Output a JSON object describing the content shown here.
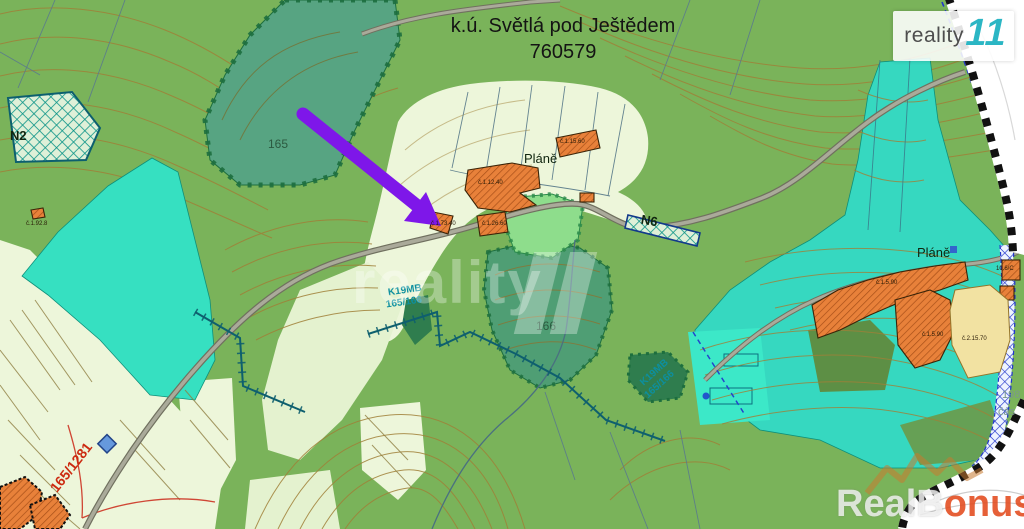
{
  "map": {
    "title": {
      "line1": "k.ú. Světlá pod Ještědem",
      "line2": "760579"
    },
    "labels": {
      "forest_parcel": "165",
      "n2": "N2",
      "parcel_red": "165/1281",
      "k19mb_a1": "K19MB",
      "k19mb_a2": "165/166",
      "k19mb_b1": "K19MB",
      "k19mb_b2": "165/166",
      "parcel_166": "166",
      "plane_center": "Pláně",
      "plane_right": "Pláně",
      "n6": "N6",
      "edge_198": "198",
      "edge_cas": "čás",
      "bld_1": "č.1.15.60",
      "bld_2": "č.1.12.40",
      "bld_3": "č.1.26.60",
      "bld_4": "č.1.73.40",
      "bld_5": "č.1.92.8",
      "bld_6": "č.1.5.90",
      "bld_7": "č.1.5.90",
      "bld_8": "č.2.15.70",
      "bld_9": "10.6/C"
    }
  },
  "branding": {
    "logo_topright": {
      "name": "reality",
      "suffix": "11"
    },
    "watermark_center": {
      "text": "reality"
    },
    "watermark_bottom": {
      "part1": "RealB",
      "part2": "onus",
      "part3": ".cz"
    }
  },
  "colors": {
    "base_green": "#7ab35a",
    "forest_teal": "#57a482",
    "bright_cyan": "#36e0c1",
    "pale_field": "#edf6da",
    "building_orange": "#e8813a",
    "arrow_purple": "#7e17e9",
    "logo_teal": "#2bb6c4",
    "bonus_orange": "#e24a1c",
    "red_label": "#cc2a10"
  }
}
